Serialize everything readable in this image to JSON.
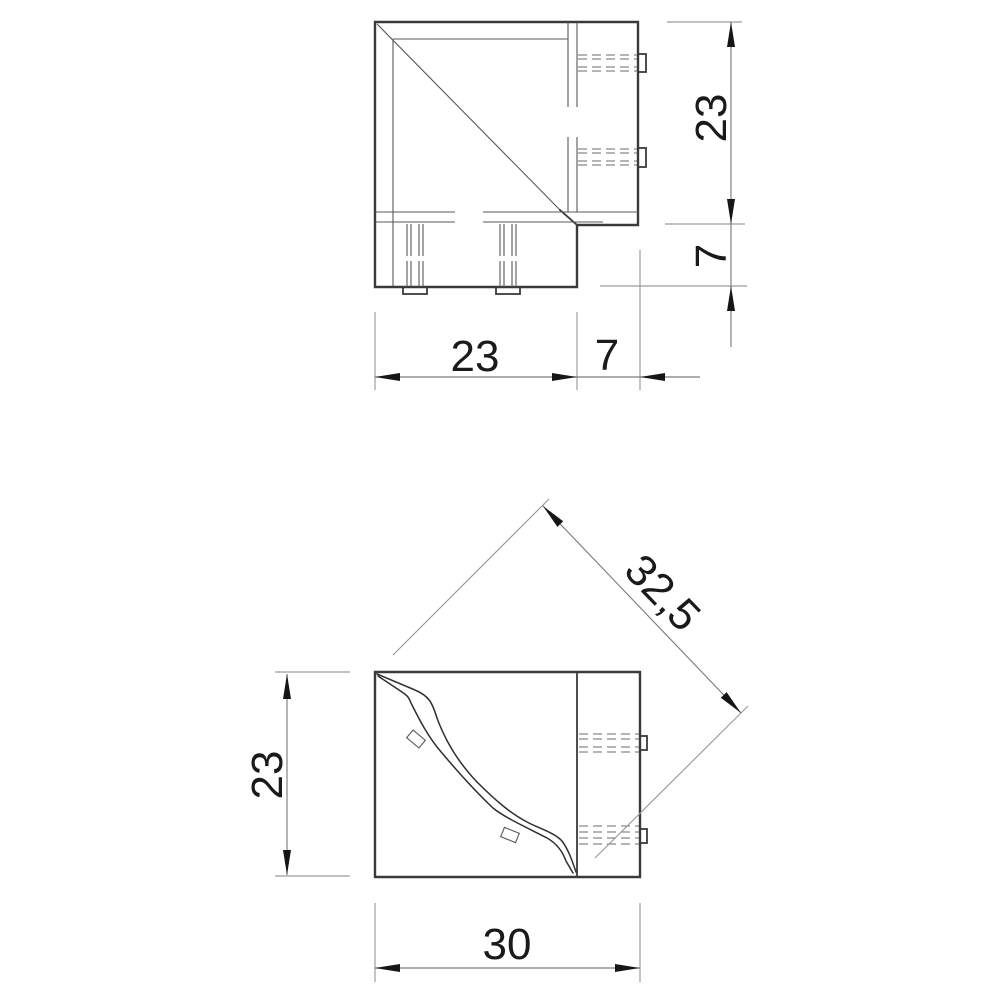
{
  "drawing": {
    "kind": "technical-dimension-drawing",
    "part": "corner connector piece (two orthographic views)",
    "background": "#ffffff",
    "colors": {
      "outline": "#3a3a3a",
      "thin_line": "#585858",
      "hidden_line": "#6b6b6b",
      "dimension_line": "#7d7d7d",
      "extension_line": "#9a9a9a",
      "arrow": "#161616",
      "text": "#1a1a1a"
    },
    "views": {
      "top_view": {
        "labels": {
          "height_main": "23",
          "height_tab": "7",
          "width_main": "23",
          "width_tab": "7"
        }
      },
      "front_view": {
        "labels": {
          "height": "23",
          "width": "30",
          "diagonal": "32,5"
        }
      }
    }
  }
}
